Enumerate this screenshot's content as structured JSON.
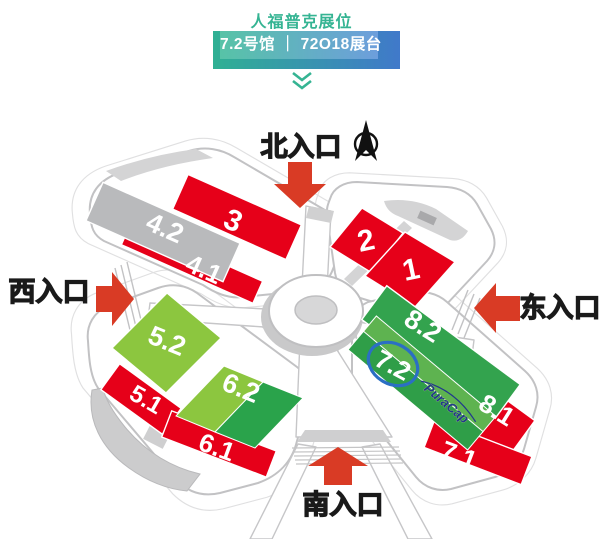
{
  "header": {
    "title": "人福普克展位",
    "badge_text": "7.2号馆 ｜ 72O18展台",
    "accent_teal": "#2fb093",
    "accent_blue": "#4079ca"
  },
  "map": {
    "entrances": {
      "north": "北入口",
      "east": "东入口",
      "south": "南入口",
      "west": "西入口"
    },
    "booth": {
      "logo_text": "PuraCap",
      "highlighted_hall": "7.2"
    },
    "halls": {
      "h3": {
        "label": "3",
        "color": "#e60019"
      },
      "h42": {
        "label": "4.2",
        "color": "#b9babc"
      },
      "h41": {
        "label": "4.1",
        "color": "#e60019"
      },
      "h2": {
        "label": "2",
        "color": "#e60019"
      },
      "h1": {
        "label": "1",
        "color": "#e60019"
      },
      "h52": {
        "label": "5.2",
        "color": "#8cc63f"
      },
      "h62": {
        "label": "6.2",
        "color_light": "#8cc63f",
        "color_dark": "#2aa34b"
      },
      "h51": {
        "label": "5.1",
        "color": "#e60019"
      },
      "h61": {
        "label": "6.1",
        "color": "#e60019"
      },
      "h82": {
        "label": "8.2",
        "color": "#33a34e"
      },
      "h72": {
        "label": "7.2",
        "color_light": "#5eb350",
        "color_dark": "#2f9e48"
      },
      "h81": {
        "label": "8.1",
        "color": "#e60019"
      },
      "h71": {
        "label": "7.1",
        "color": "#e60019"
      }
    },
    "colors": {
      "arrow_red": "#d93b25",
      "entrance_text": "#1a1a1a",
      "building_outline": "#c2c2c4",
      "roof_gray": "#d4d4d5",
      "highlight_ring": "#2b6fc4",
      "logo_blue": "#21388c"
    }
  }
}
